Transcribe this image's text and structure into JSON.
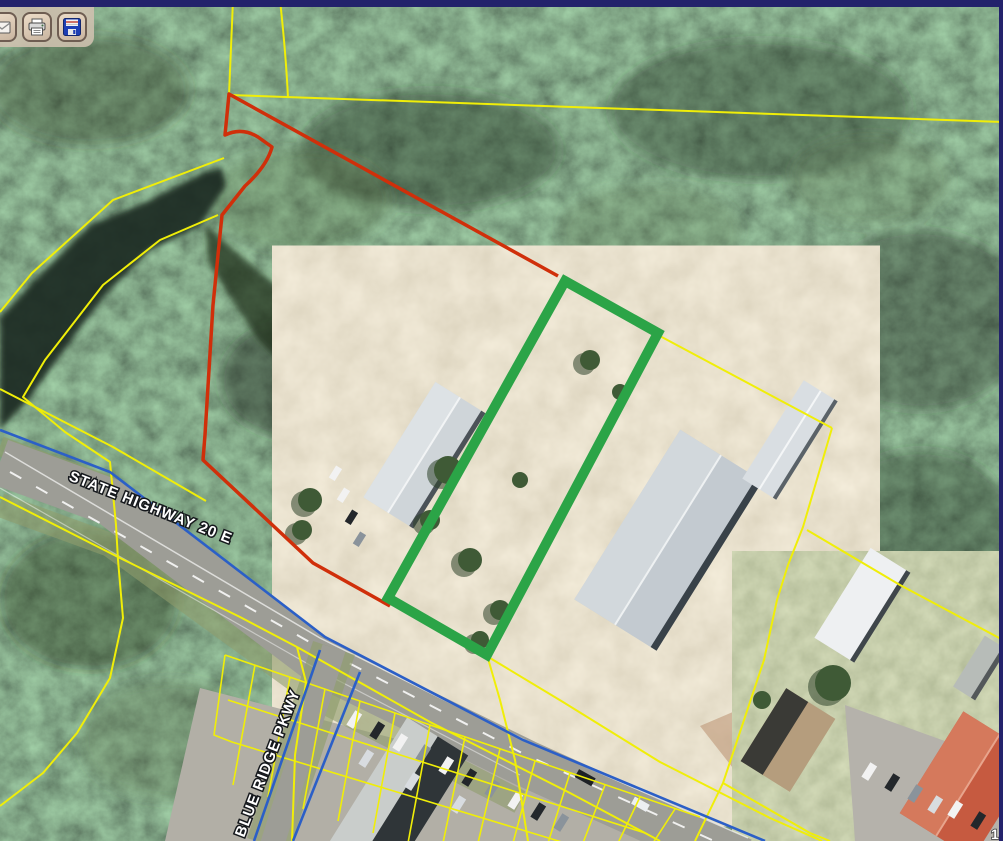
{
  "window": {
    "top_bar_color": "#23226B",
    "right_bar_color": "#23226B"
  },
  "toolbar": {
    "buttons": [
      {
        "label": "Mail",
        "icon": "mail-icon"
      },
      {
        "label": "Print",
        "icon": "printer-icon"
      },
      {
        "label": "Save",
        "icon": "save-icon"
      }
    ]
  },
  "map": {
    "type": "aerial-parcel-view",
    "labels": [
      {
        "text": "STATE HIGHWAY 20 E"
      },
      {
        "text": "BLUE RIDGE PKWY"
      }
    ],
    "scale_text": "1",
    "overlay_colors": {
      "selected_parcel_highlight": "#2BA447",
      "subject_boundary": "#D02F0A",
      "parcel_lines": "#F0EE08",
      "road_centerlines": "#2B5FC7"
    }
  }
}
